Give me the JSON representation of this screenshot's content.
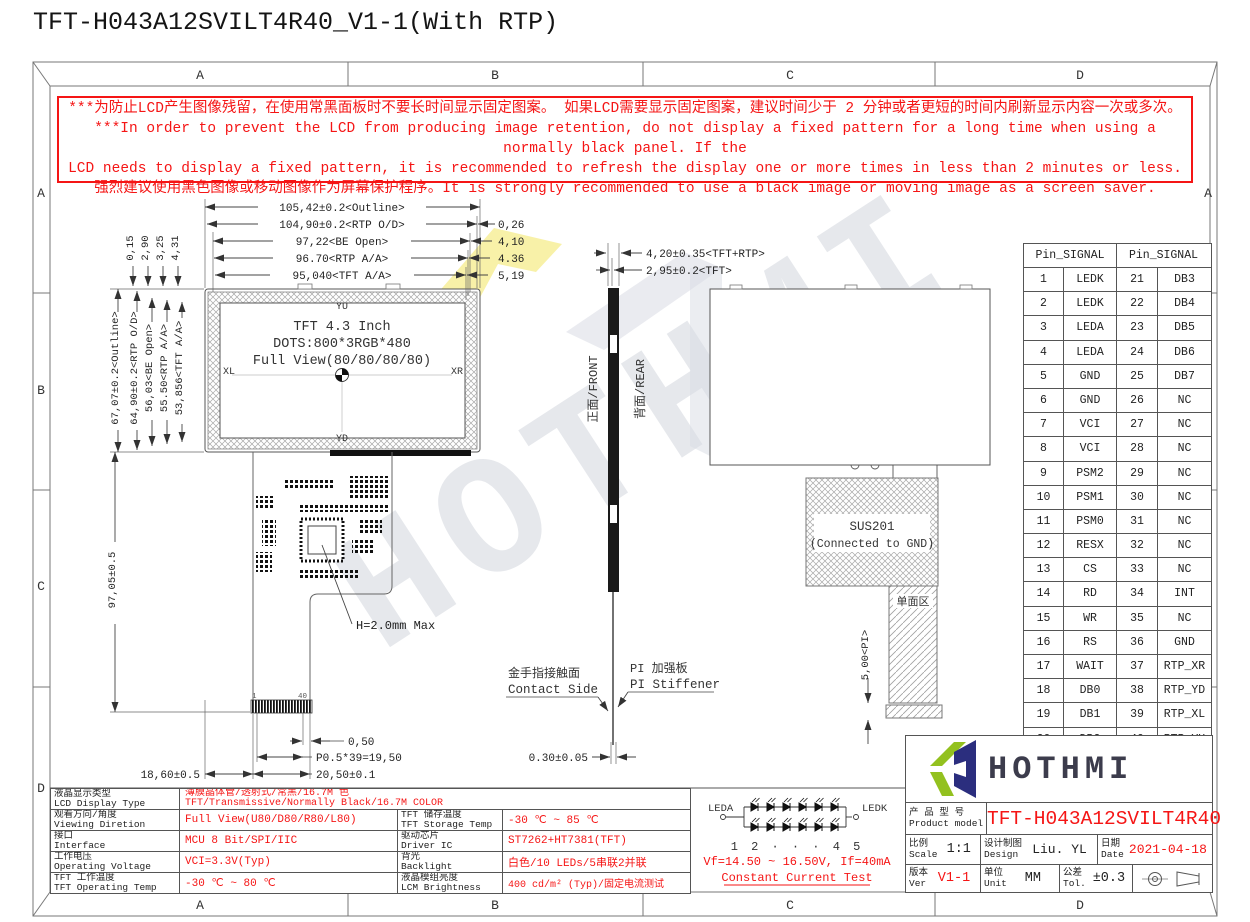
{
  "title": "TFT-H043A12SVILT4R40_V1-1(With RTP)",
  "colors": {
    "red": "#f51515",
    "logo_green": "#93c11f",
    "logo_navy": "#2b2e7e",
    "ink": "#3c3c4c"
  },
  "border": {
    "letters": [
      "A",
      "B",
      "C",
      "D"
    ]
  },
  "warning": {
    "line1": "***为防止LCD产生图像残留，在使用常黑面板时不要长时间显示固定图案。 如果LCD需要显示固定图案，建议时间少于 2 分钟或者更短的时间内刷新显示内容一次或多次。",
    "line2": "***In order to prevent the LCD from producing image retention, do not display a fixed pattern for a long time when using a normally black panel. If the",
    "line3": "LCD needs to display a fixed pattern, it is recommended to refresh the display one or more times in less than 2 minutes or less.",
    "line4": "强烈建议使用黑色图像或移动图像作为屏幕保护程序。It is strongly recommended to use a black image or moving image as a screen saver."
  },
  "front_view": {
    "yu": "YU",
    "yd": "YD",
    "xl": "XL",
    "xr": "XR",
    "size": "TFT 4.3 Inch",
    "dots": "DOTS:800*3RGB*480",
    "view": "Full View(80/80/80/80)"
  },
  "dims": {
    "top": [
      "105,42±0.2<Outline>",
      "104,90±0.2<RTP O/D>",
      "97,22<BE Open>",
      "96.70<RTP A/A>",
      "95,040<TFT A/A>"
    ],
    "top_right": [
      "0,26",
      "4,10",
      "4.36",
      "5,19"
    ],
    "top_small": [
      "0,15",
      "2,90",
      "3,25",
      "4,31"
    ],
    "left": [
      "67,07±0.2<Outline>",
      "64,90±0.2<RTP O/D>",
      "56,03<BE Open>",
      "55.50<RTP A/A>",
      "53,856<TFT A/A>"
    ],
    "fpc_len": "97,05±0.5",
    "side1": "4,20±0.35<TFT+RTP>",
    "side2": "2,95±0.2<TFT>",
    "thick": "0.30±0.05",
    "pi": "5,00<PI>",
    "h_max": "H=2.0mm Max",
    "p050": "0,50",
    "pitch": "P0.5*39=19,50",
    "w205": "20,50±0.1",
    "w186": "18,60±0.5",
    "pin1": "1",
    "pin40": "40"
  },
  "side_view": {
    "front": "正面/FRONT",
    "rear": "背面/REAR",
    "contact_cn": "金手指接触面",
    "contact_en": "Contact Side",
    "stiff_cn": "PI 加强板",
    "stiff_en": "PI Stiffener"
  },
  "rear_view": {
    "sus1": "SUS201",
    "sus2": "(Connected to GND)",
    "single": "单面区"
  },
  "led": {
    "a": "LEDA",
    "k": "LEDK",
    "index": "1 2 · · · 4 5",
    "vf": "Vf=14.50 ~ 16.50V, If=40mA",
    "cc": "Constant Current Test"
  },
  "pin_table": {
    "header": "Pin_SIGNAL",
    "rows": [
      [
        "1",
        "LEDK",
        "21",
        "DB3"
      ],
      [
        "2",
        "LEDK",
        "22",
        "DB4"
      ],
      [
        "3",
        "LEDA",
        "23",
        "DB5"
      ],
      [
        "4",
        "LEDA",
        "24",
        "DB6"
      ],
      [
        "5",
        "GND",
        "25",
        "DB7"
      ],
      [
        "6",
        "GND",
        "26",
        "NC"
      ],
      [
        "7",
        "VCI",
        "27",
        "NC"
      ],
      [
        "8",
        "VCI",
        "28",
        "NC"
      ],
      [
        "9",
        "PSM2",
        "29",
        "NC"
      ],
      [
        "10",
        "PSM1",
        "30",
        "NC"
      ],
      [
        "11",
        "PSM0",
        "31",
        "NC"
      ],
      [
        "12",
        "RESX",
        "32",
        "NC"
      ],
      [
        "13",
        "CS",
        "33",
        "NC"
      ],
      [
        "14",
        "RD",
        "34",
        "INT"
      ],
      [
        "15",
        "WR",
        "35",
        "NC"
      ],
      [
        "16",
        "RS",
        "36",
        "GND"
      ],
      [
        "17",
        "WAIT",
        "37",
        "RTP_XR"
      ],
      [
        "18",
        "DB0",
        "38",
        "RTP_YD"
      ],
      [
        "19",
        "DB1",
        "39",
        "RTP_XL"
      ],
      [
        "20",
        "DB2",
        "40",
        "RTP_YU"
      ]
    ]
  },
  "spec": {
    "r1": {
      "cn": "液晶显示类型",
      "en": "LCD Display Type",
      "vcn": "薄膜晶体管/透射式/常黑/16.7M 色",
      "ven": "TFT/Transmissive/Normally Black/16.7M COLOR"
    },
    "r2": {
      "cn": "观看方向/角度",
      "en": "Viewing Diretion",
      "v": "Full View(U80/D80/R80/L80)",
      "cn2": "TFT 储存温度",
      "en2": "TFT Storage Temp",
      "v2": "-30 ℃ ~ 85 ℃"
    },
    "r3": {
      "cn": "接口",
      "en": "Interface",
      "v": "MCU 8 Bit/SPI/IIC",
      "cn2": "驱动芯片",
      "en2": "Driver IC",
      "v2": "ST7262+HT7381(TFT)"
    },
    "r4": {
      "cn": "工作电压",
      "en": "Operating Voltage",
      "v": "VCI=3.3V(Typ)",
      "cn2": "背光",
      "en2": "Backlight",
      "v2": "白色/10 LEDs/5串联2并联"
    },
    "r5": {
      "cn": "TFT 工作温度",
      "en": "TFT Operating Temp",
      "v": "-30 ℃ ~ 80 ℃",
      "cn2": "液晶模组亮度",
      "en2": "LCM Brightness",
      "v2": "400 cd/m² (Typ)/固定电流测试"
    }
  },
  "title_block": {
    "logo_text": "HOTHMI",
    "product_label_cn": "产 品 型 号",
    "product_label_en": "Product model",
    "model": "TFT-H043A12SVILT4R40",
    "scale_cn": "比例",
    "scale_en": "Scale",
    "scale_val": "1:1",
    "design_cn": "设计制图",
    "design_en": "Design",
    "design_val": "Liu. YL",
    "date_cn": "日期",
    "date_en": "Date",
    "date_val": "2021-04-18",
    "ver_cn": "版本",
    "ver_en": "Ver",
    "ver_val": "V1-1",
    "unit_cn": "单位",
    "unit_en": "Unit",
    "unit_val": "MM",
    "tol_cn": "公差",
    "tol_en": "Tol.",
    "tol_val": "±0.3"
  }
}
